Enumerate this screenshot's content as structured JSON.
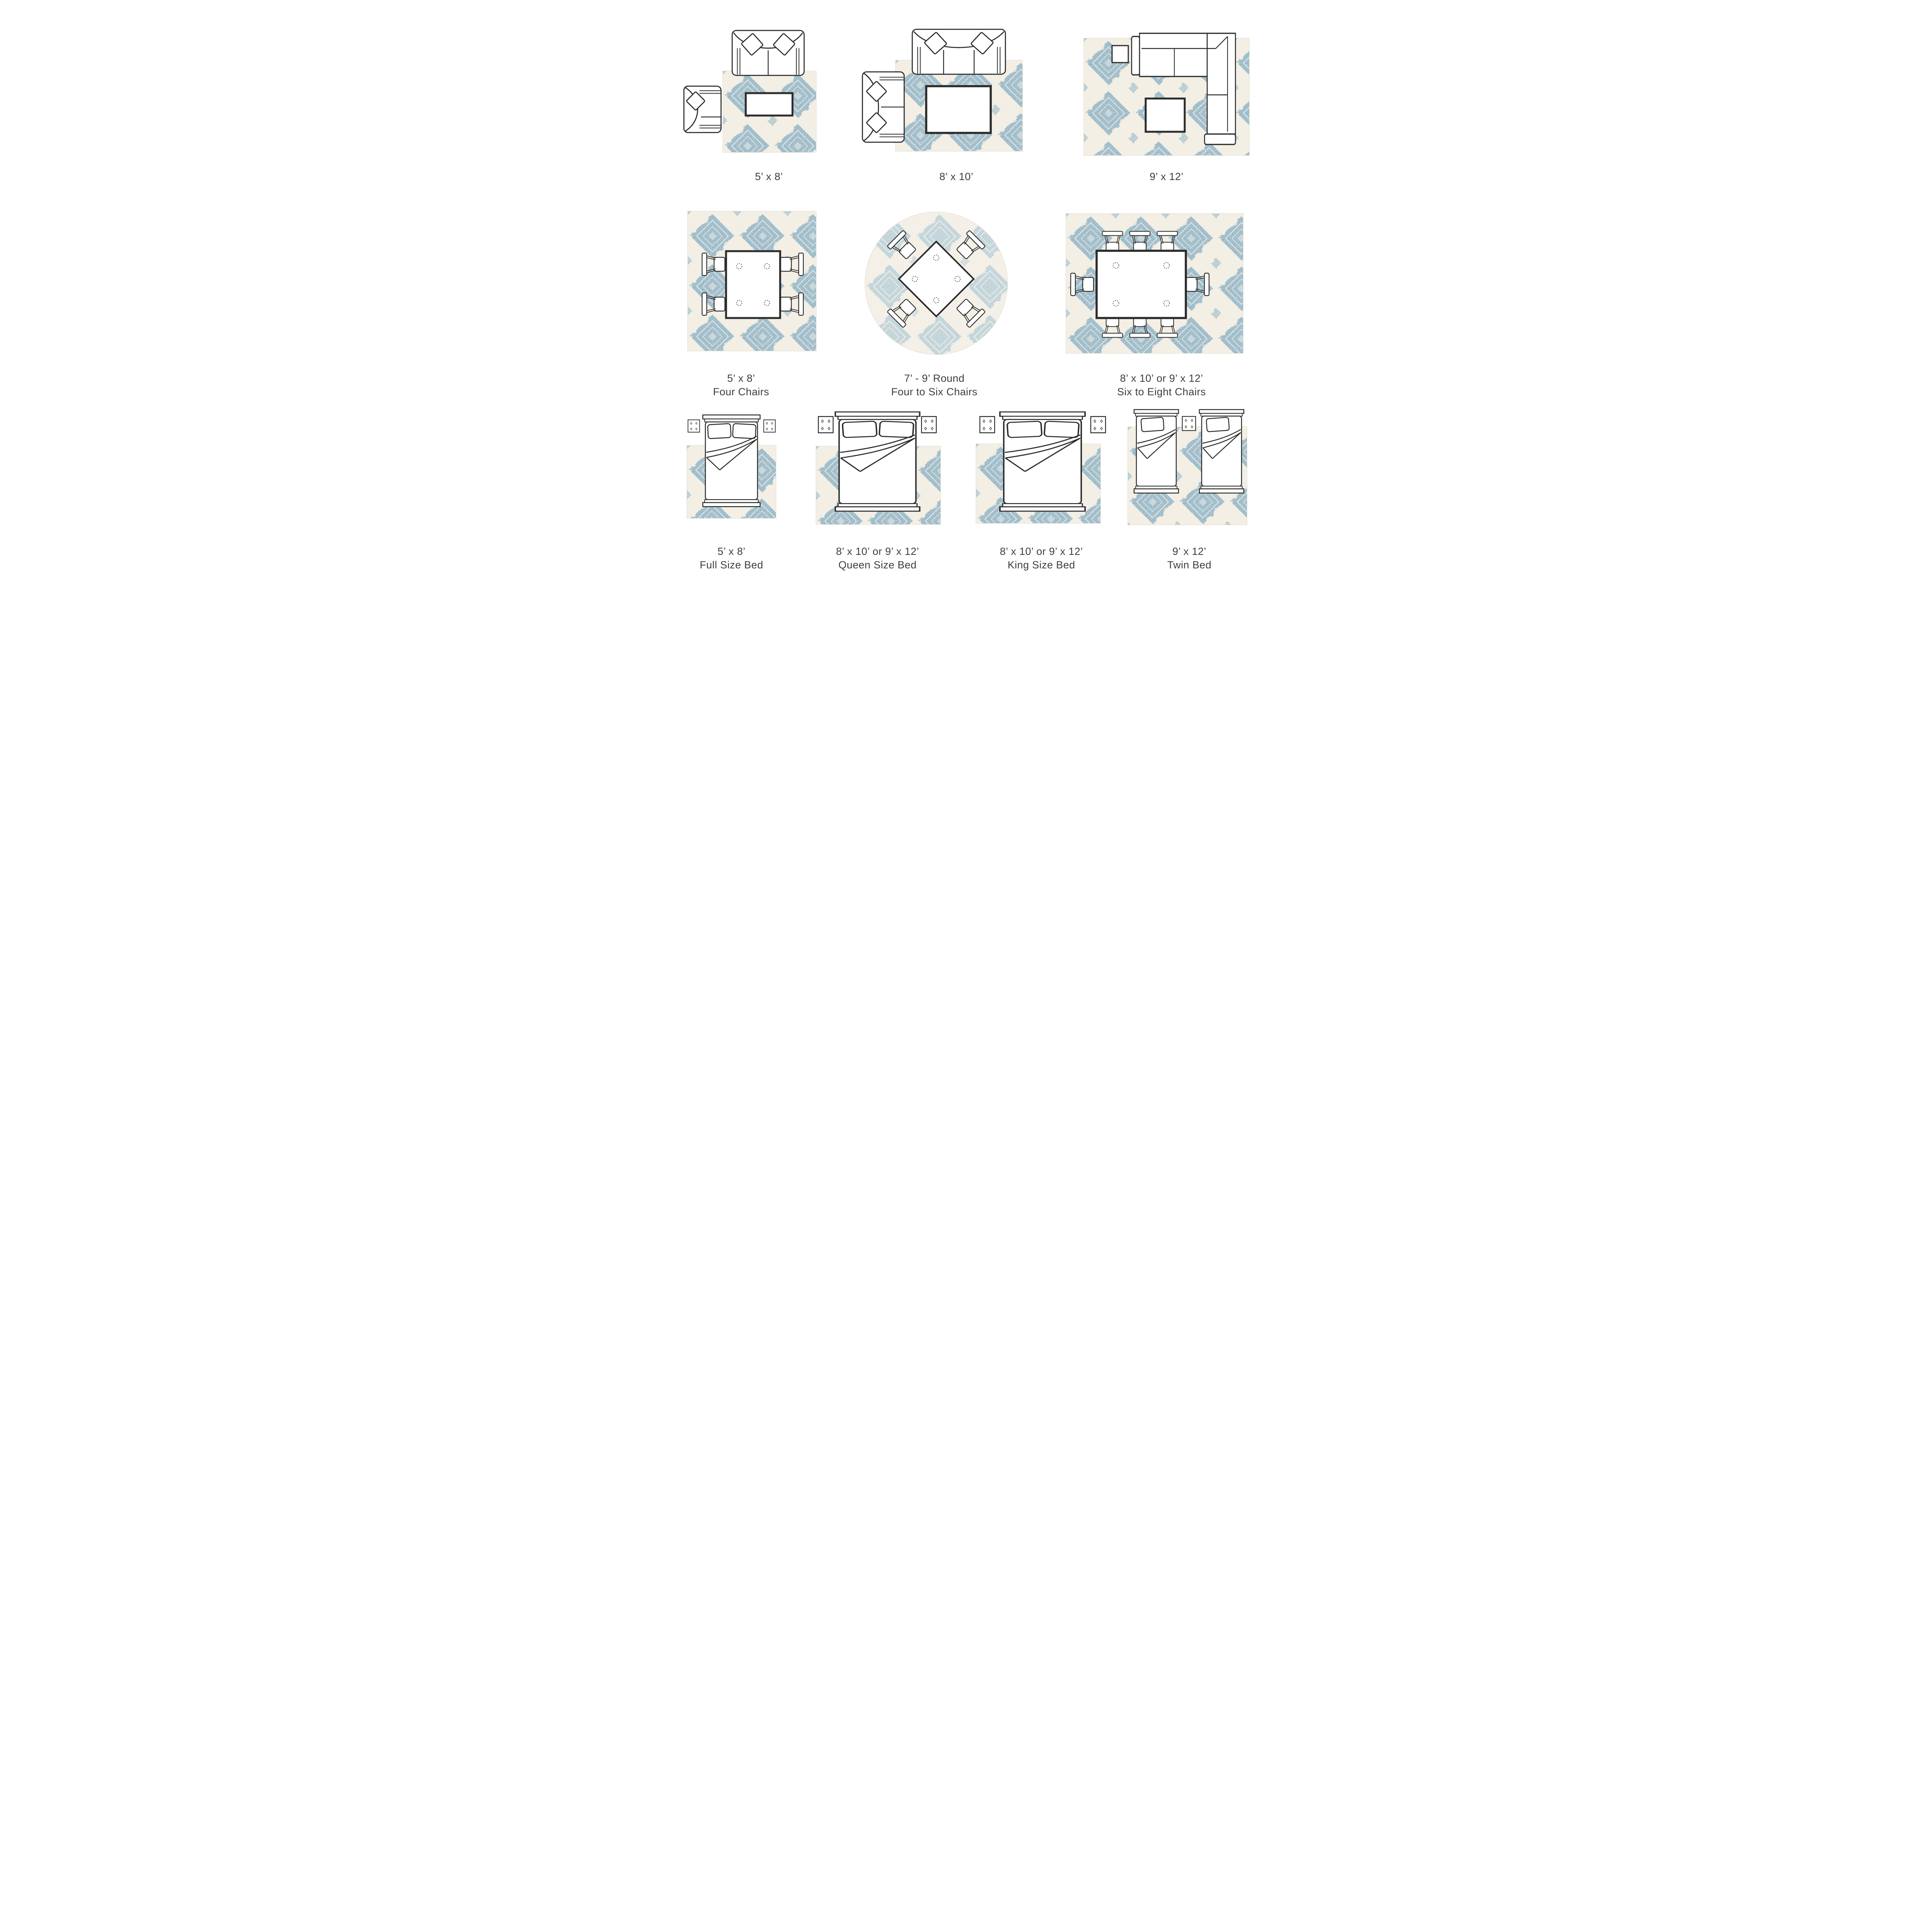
{
  "page": {
    "background_color": "#ffffff",
    "text_color": "#3e3e3e",
    "title": "Rug size placement guide"
  },
  "rug": {
    "pattern": "damask-trellis",
    "blue": "#8fb3c6",
    "blue_light": "#b6d0dc",
    "cream": "#f3efe5",
    "furniture_outline": "#2b2b2b"
  },
  "sections": [
    {
      "name": "living-room",
      "cells": [
        {
          "size_label": "5’ x 8’",
          "sub_label": "",
          "rug_shape": "rectangle",
          "furniture": [
            "sofa",
            "armchair",
            "coffee-table"
          ]
        },
        {
          "size_label": "8’ x 10’",
          "sub_label": "",
          "rug_shape": "rectangle",
          "furniture": [
            "sofa",
            "loveseat",
            "coffee-table"
          ]
        },
        {
          "size_label": "9’ x 12’",
          "sub_label": "",
          "rug_shape": "rectangle",
          "furniture": [
            "sectional-sofa",
            "side-table",
            "coffee-table"
          ]
        }
      ]
    },
    {
      "name": "dining-room",
      "cells": [
        {
          "size_label": "5’ x 8’",
          "sub_label": "Four Chairs",
          "rug_shape": "rectangle",
          "furniture": [
            "dining-table",
            "four-chairs"
          ]
        },
        {
          "size_label": "7’ - 9’ Round",
          "sub_label": "Four to Six Chairs",
          "rug_shape": "round",
          "furniture": [
            "square-table",
            "four-chairs"
          ]
        },
        {
          "size_label": "8’ x 10’ or 9’ x 12’",
          "sub_label": "Six to Eight Chairs",
          "rug_shape": "rectangle",
          "furniture": [
            "dining-table",
            "eight-chairs"
          ]
        }
      ]
    },
    {
      "name": "bedroom",
      "cells": [
        {
          "size_label": "5’ x 8’",
          "sub_label": "Full Size Bed",
          "rug_shape": "rectangle",
          "furniture": [
            "full-bed",
            "two-nightstands"
          ]
        },
        {
          "size_label": "8’ x 10’ or 9’ x 12’",
          "sub_label": "Queen Size Bed",
          "rug_shape": "rectangle",
          "furniture": [
            "queen-bed",
            "two-nightstands"
          ]
        },
        {
          "size_label": "8’ x 10’ or 9’ x 12’",
          "sub_label": "King Size Bed",
          "rug_shape": "rectangle",
          "furniture": [
            "king-bed",
            "two-nightstands"
          ]
        },
        {
          "size_label": "9’ x 12’",
          "sub_label": "Twin Bed",
          "rug_shape": "rectangle",
          "furniture": [
            "twin-bed",
            "twin-bed",
            "nightstand"
          ]
        }
      ]
    }
  ]
}
